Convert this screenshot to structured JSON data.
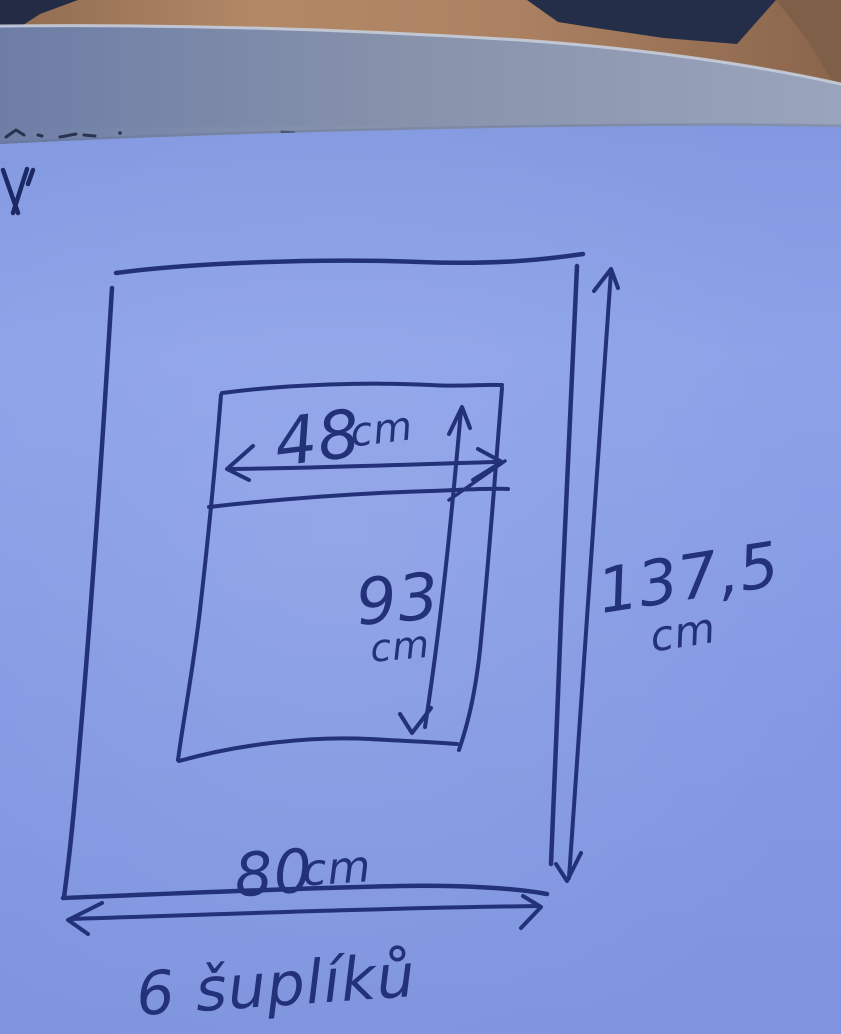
{
  "sketch": {
    "caption": "6 šuplíků",
    "dimensions": {
      "inner_width": {
        "value": "48",
        "unit": "cm"
      },
      "inner_height": {
        "value": "93",
        "unit": "cm"
      },
      "outer_height": {
        "value": "137,5",
        "unit": "cm"
      },
      "outer_width": {
        "value": "80",
        "unit": "cm"
      }
    },
    "colors": {
      "ink": "#233179",
      "paper": "#8098e2",
      "under_sheet": "#8a95b0",
      "skin": "#a87f60",
      "clothing": "#242c44"
    }
  }
}
